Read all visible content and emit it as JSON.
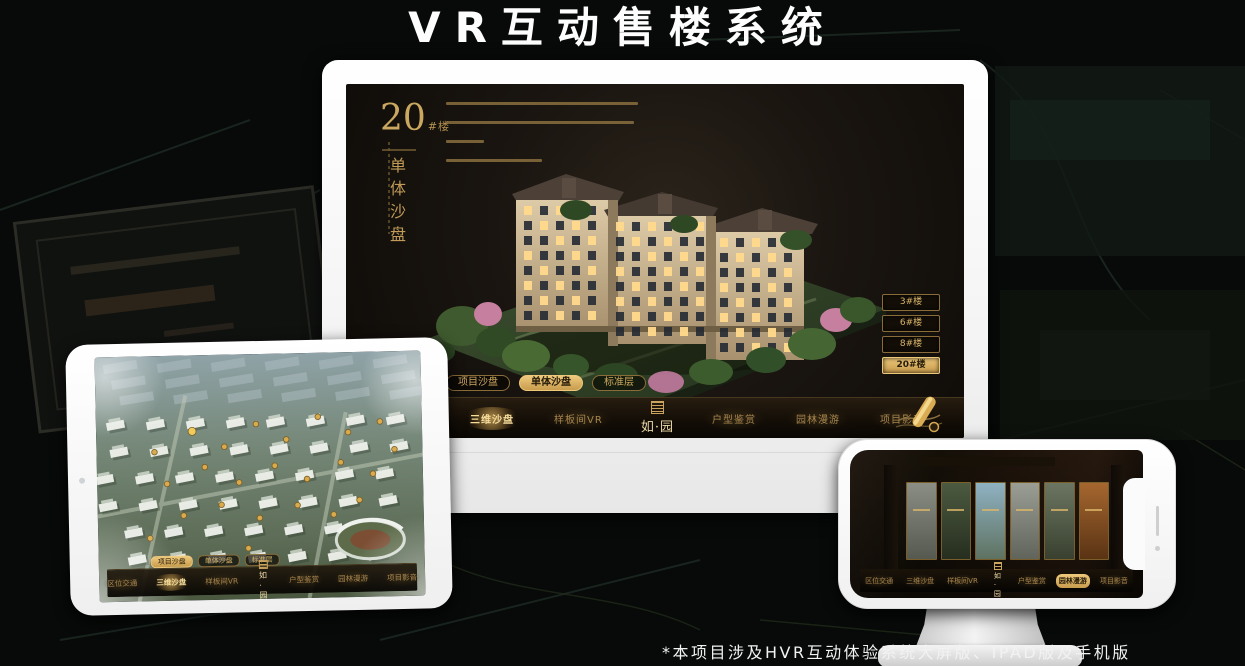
{
  "page": {
    "title": "VR互动售楼系统",
    "footnote": "*本项目涉及HVR互动体验系统大屏版、IPAD版及手机版"
  },
  "colors": {
    "gold": "#c9a35f",
    "gold_bright": "#eec97c",
    "active_text": "#241a08",
    "screen_bg": "#1a1510",
    "platform_green": "#35452b",
    "lit_window": "#ffd98c"
  },
  "monitor_ui": {
    "hero": {
      "number": "20",
      "suffix": "#楼",
      "subtitle_vertical": "单体沙盘"
    },
    "floor_buttons": [
      {
        "label": "3#楼",
        "active": false
      },
      {
        "label": "6#楼",
        "active": false
      },
      {
        "label": "8#楼",
        "active": false
      },
      {
        "label": "20#楼",
        "active": true
      }
    ],
    "sub_tabs": [
      {
        "label": "项目沙盘",
        "active": false
      },
      {
        "label": "单体沙盘",
        "active": true
      },
      {
        "label": "标准层",
        "active": false
      }
    ],
    "nav_items": [
      {
        "label": "区位交通",
        "active": false
      },
      {
        "label": "三维沙盘",
        "active": true
      },
      {
        "label": "样板间VR",
        "active": false
      },
      {
        "label": "户型鉴赏",
        "active": false
      },
      {
        "label": "园林漫游",
        "active": false
      },
      {
        "label": "项目影音",
        "active": false
      }
    ],
    "logo": "如·园"
  },
  "tablet_ui": {
    "sub_tabs": [
      {
        "label": "项目沙盘",
        "active": true
      },
      {
        "label": "单体沙盘",
        "active": false
      },
      {
        "label": "标准层",
        "active": false
      }
    ],
    "nav_items": [
      {
        "label": "区位交通",
        "active": false
      },
      {
        "label": "三维沙盘",
        "active": true
      },
      {
        "label": "样板间VR",
        "active": false
      },
      {
        "label": "户型鉴赏",
        "active": false
      },
      {
        "label": "园林漫游",
        "active": false
      },
      {
        "label": "项目影音",
        "active": false
      }
    ],
    "logo": "如·园"
  },
  "phone_ui": {
    "nav_items": [
      {
        "label": "区位交通",
        "active": false
      },
      {
        "label": "三维沙盘",
        "active": false
      },
      {
        "label": "样板间VR",
        "active": false
      },
      {
        "label": "户型鉴赏",
        "active": false
      },
      {
        "label": "园林漫游",
        "active": true
      },
      {
        "label": "项目影音",
        "active": false
      }
    ],
    "logo": "如·园"
  }
}
